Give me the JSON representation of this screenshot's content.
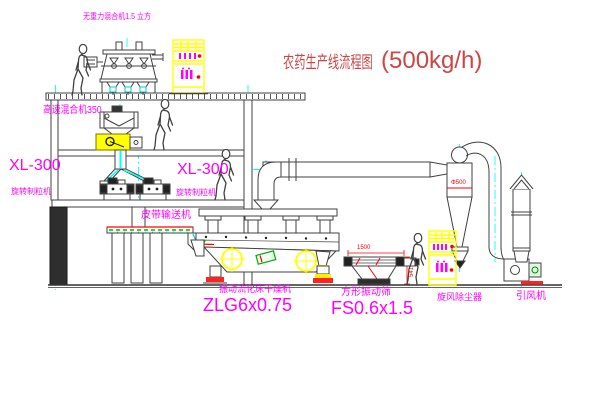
{
  "title": {
    "cn": "农药生产线流程图",
    "capacity": "(500kg/h)"
  },
  "labels": {
    "gravity_mixer": "无重力混合机1.5 立方",
    "high_speed_mixer": "高速混合机350",
    "granulator_left_model": "XL-300",
    "granulator_left_name": "旋转制粒机",
    "granulator_mid_model": "XL-300",
    "granulator_mid_name": "旋转制粒机",
    "belt_conveyor": "皮带输送机",
    "dryer_name": "振动流化床干燥机",
    "dryer_model": "ZLG6x0.75",
    "sieve_name": "方形振动筛",
    "sieve_model": "FS0.6x1.5",
    "cyclone_name": "旋风除尘器",
    "fan_name": "引风机"
  },
  "dimensions": {
    "sieve_length": "1500",
    "sieve_height": "541",
    "cyclone_dia": "Φ500"
  },
  "colors": {
    "label_magenta": "#ff00ff",
    "title_red": "#cc4646",
    "dim_red": "#ff0000",
    "cabinet_yellow": "#ffff00",
    "centerline_cyan": "#00ffff",
    "line_dark": "#404040"
  }
}
